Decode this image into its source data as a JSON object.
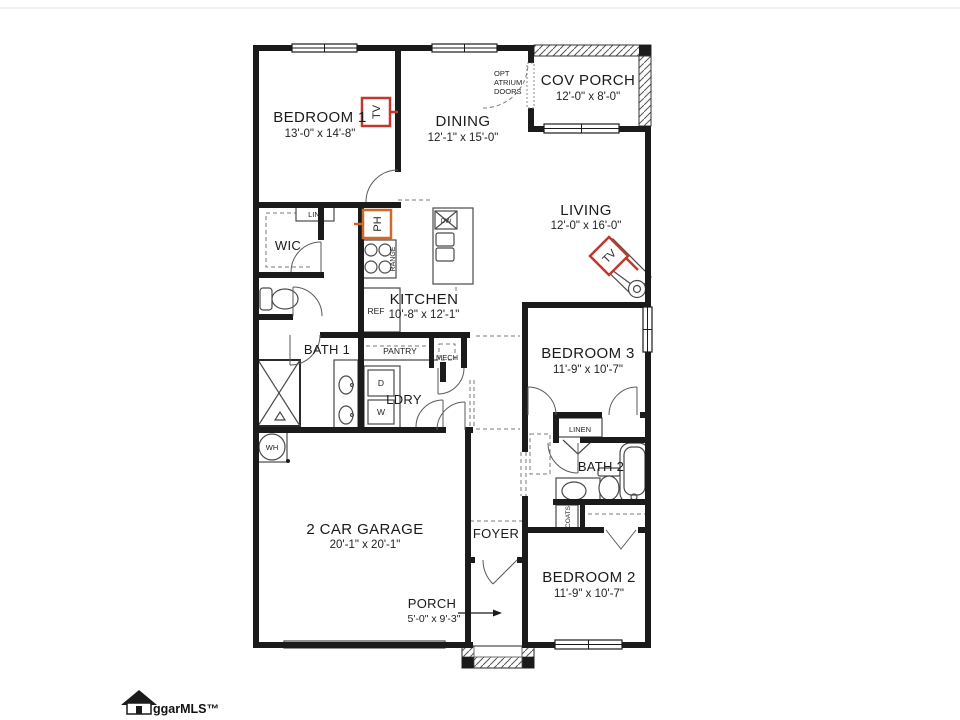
{
  "rooms": {
    "bedroom1": {
      "name": "BEDROOM 1",
      "dims": "13'-0\" x 14'-8\""
    },
    "dining": {
      "name": "DINING",
      "dims": "12'-1\" x 15'-0\""
    },
    "cov_porch": {
      "name": "COV PORCH",
      "dims": "12'-0\" x 8'-0\""
    },
    "living": {
      "name": "LIVING",
      "dims": "12'-0\" x 16'-0\""
    },
    "kitchen": {
      "name": "KITCHEN",
      "dims": "10'-8\" x 12'-1\""
    },
    "wic": {
      "name": "WIC"
    },
    "bath1": {
      "name": "BATH 1"
    },
    "pantry": {
      "name": "PANTRY"
    },
    "mech": {
      "name": "MECH"
    },
    "ldry": {
      "name": "LDRY"
    },
    "bedroom3": {
      "name": "BEDROOM 3",
      "dims": "11'-9\" x 10'-7\""
    },
    "linen": {
      "name": "LINEN"
    },
    "bath2": {
      "name": "BATH 2"
    },
    "coats": {
      "name": "COATS"
    },
    "bedroom2": {
      "name": "BEDROOM 2",
      "dims": "11'-9\" x 10'-7\""
    },
    "garage": {
      "name": "2 CAR GARAGE",
      "dims": "20'-1\" x 20'-1\""
    },
    "foyer": {
      "name": "FOYER"
    },
    "porch": {
      "name": "PORCH",
      "dims": "5'-0\" x 9'-3\""
    }
  },
  "notes": {
    "opt": "OPT",
    "atrium": "ATRIUM",
    "doors": "DOORS"
  },
  "appliances": {
    "range": "RANGE",
    "ref": "REF",
    "dw": "DW",
    "dryer": "D",
    "washer": "W",
    "water_heater": "WH",
    "lin": "LIN."
  },
  "markers": {
    "tv": "TV",
    "ph": "PH"
  },
  "watermark": {
    "text": "ggarMLS™"
  },
  "colors": {
    "wall": "#1b1b1b",
    "tv_red": "#c2372e",
    "ph_orange": "#d06a2c",
    "fixture": "#4a4a4a"
  }
}
